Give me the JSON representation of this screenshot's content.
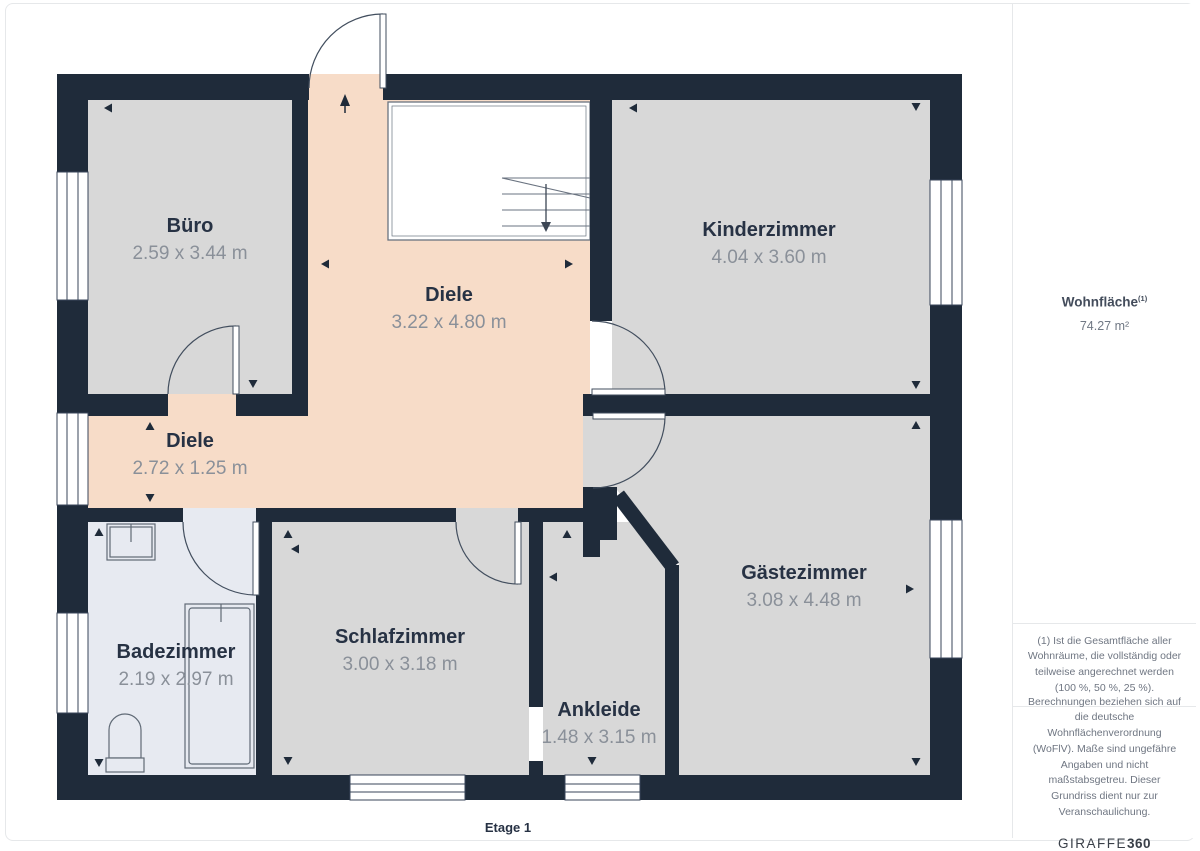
{
  "floorplan": {
    "floor_label": "Etage 1",
    "rooms": {
      "buero": {
        "name": "Büro",
        "dims": "2.59 x 3.44 m"
      },
      "diele_og": {
        "name": "Diele",
        "dims": "3.22 x 4.80 m"
      },
      "kinderzimmer": {
        "name": "Kinderzimmer",
        "dims": "4.04 x 3.60 m"
      },
      "diele_flur": {
        "name": "Diele",
        "dims": "2.72 x 1.25 m"
      },
      "badezimmer": {
        "name": "Badezimmer",
        "dims": "2.19 x 2.97 m"
      },
      "schlafzimmer": {
        "name": "Schlafzimmer",
        "dims": "3.00 x 3.18 m"
      },
      "ankleide": {
        "name": "Ankleide",
        "dims": "1.48 x 3.15 m"
      },
      "gaestezimmer": {
        "name": "Gästezimmer",
        "dims": "3.08 x 4.48 m"
      }
    },
    "colors": {
      "wall": "#1f2b3a",
      "room_fill": "#d8d8d8",
      "hall_fill": "#f7dcc8",
      "bath_fill": "#e7eaf1",
      "label_text": "#273244",
      "dims_text": "#8a9099"
    }
  },
  "sidebar": {
    "area_label": "Wohnfläche",
    "area_superscript": "(1)",
    "area_value": "74.27 m²",
    "footnote_1": "(1) Ist die Gesamtfläche aller Wohnräume, die vollständig oder teilweise angerechnet werden (100 %, 50 %, 25 %).",
    "footnote_2": "Berechnungen beziehen sich auf die deutsche Wohnflächenverordnung (WoFlV). Maße sind ungefähre Angaben und nicht maßstabsgetreu. Dieser Grundriss dient nur zur Veranschaulichung.",
    "brand": {
      "regular": "GIRAFFE",
      "bold": "360"
    }
  }
}
